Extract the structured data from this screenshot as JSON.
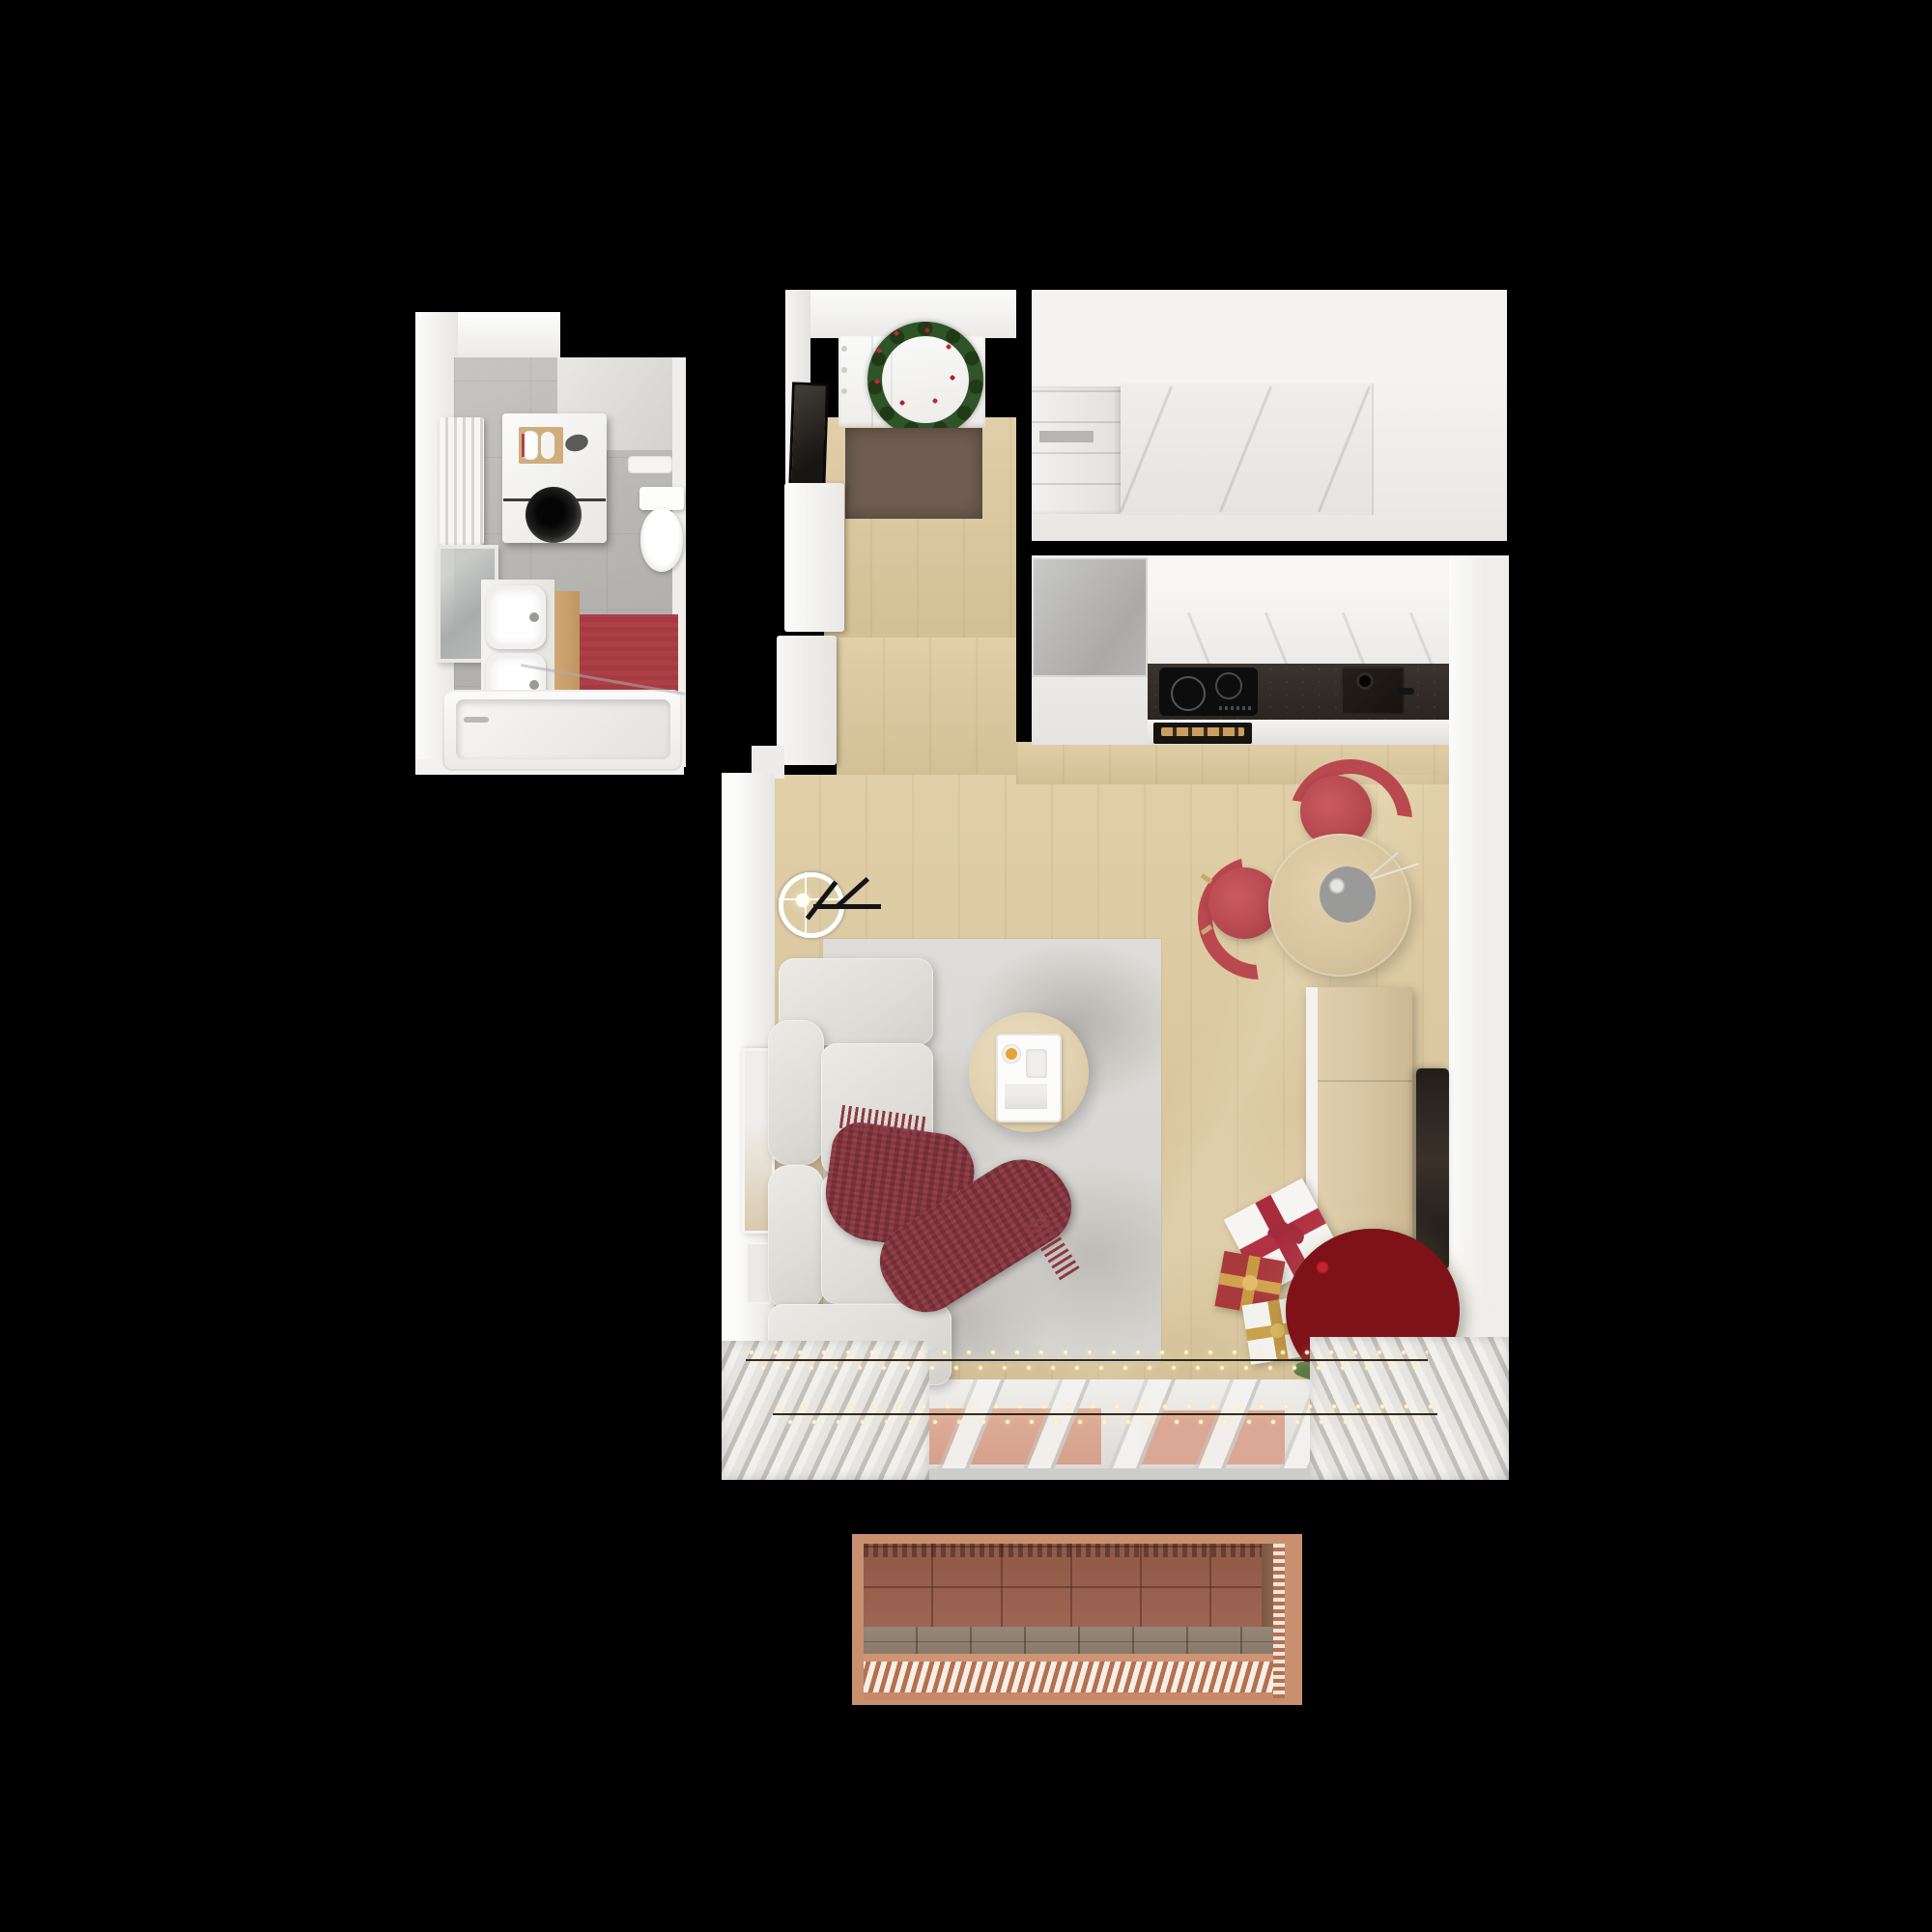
{
  "meta": {
    "type": "3d-floor-plan-render",
    "description": "Top-down dollhouse render of a studio apartment decorated for Christmas",
    "background": "#000000"
  },
  "palette": {
    "wood_floor": "#d9c79f",
    "wall_white": "#efeeec",
    "bath_tile": "#b5b4b1",
    "doormat_brown": "#6f5d51",
    "bath_mat_red": "#ae3f46",
    "chair_red": "#bb4950",
    "throw_burgundy": "#8a3a44",
    "counter_dark": "#2f2925",
    "fridge_gray": "#b4b3b1",
    "table_wood": "#d6c49e",
    "tree_green": "#2f4a24",
    "ornament_red": "#c4242e",
    "ornament_gold": "#c9a351",
    "fairy_light_warm": "#fff2cc",
    "curtain_gray": "#cfccc8",
    "tv_black": "#241e1a",
    "balcony_terracotta": "#9b6252",
    "balcony_copper": "#c8906f"
  },
  "rooms": {
    "bathroom": {
      "label": "Bathroom",
      "objects": [
        "radiator",
        "washing-machine",
        "towel-tray",
        "flush-plate",
        "toilet",
        "mirror",
        "double-basin-vanity",
        "red-bath-mat",
        "bathtub"
      ]
    },
    "hallway": {
      "label": "Entry hallway",
      "objects": [
        "entry-door",
        "christmas-wreath",
        "doormat",
        "leaning-mirror",
        "shoe-cabinets"
      ]
    },
    "wardrobe": {
      "label": "Wardrobe room",
      "objects": [
        "sliding-door-wardrobe",
        "open-shelf-unit"
      ]
    },
    "kitchen": {
      "label": "Kitchen",
      "objects": [
        "fridge",
        "upper-cabinets",
        "dark-countertop",
        "induction-hob",
        "sink",
        "oven-with-wood-handle"
      ]
    },
    "dining": {
      "label": "Dining corner",
      "objects": [
        "round-wood-table",
        "red-chair-top",
        "red-chair-left",
        "bowl-of-ornaments"
      ]
    },
    "living": {
      "label": "Living room",
      "objects": [
        "corner-sofa",
        "burgundy-throw",
        "area-rug",
        "round-coffee-table",
        "serving-tray",
        "ring-floor-lamp",
        "sideboard",
        "wall-tv",
        "christmas-tree",
        "gift-boxes",
        "string-lights",
        "curtains",
        "window-wall",
        "picture-frames"
      ]
    },
    "balcony": {
      "label": "Balcony",
      "objects": [
        "terracotta-tile-wall",
        "plank-floor",
        "slatted-railing"
      ]
    }
  }
}
